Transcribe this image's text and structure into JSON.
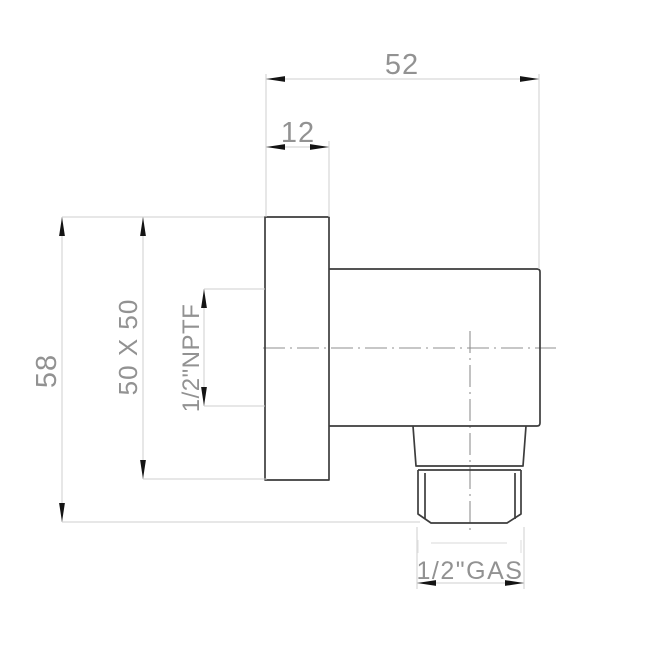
{
  "dimensions": {
    "overall_depth": "52",
    "flange_thickness": "12",
    "overall_height": "58",
    "flange_size": "50 X 50",
    "inlet_thread": "1/2\"NPTF",
    "outlet_thread": "1/2\"GAS"
  },
  "colors": {
    "background": "#ffffff",
    "part_outline": "#3d3d3d",
    "dimension_line": "#cfcfcf",
    "centerline": "#8f8f8f",
    "arrowhead": "#141414",
    "dimension_text": "#929292"
  }
}
